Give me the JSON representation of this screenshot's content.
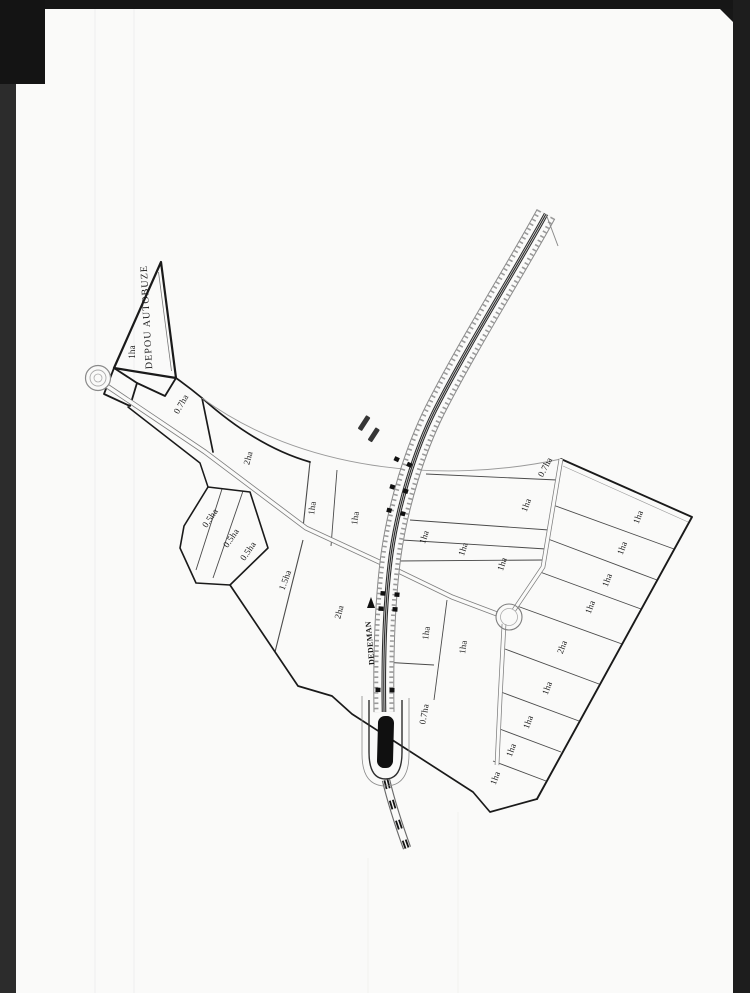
{
  "scan": {
    "frame": {
      "top_color": "#161616",
      "left_bar_color": "#2c2c2c",
      "left_corner_block_color": "#141414",
      "right_bar_color": "#1d1d1d"
    },
    "page_color": "#fafaf9",
    "ink_color": "#1b1b1b"
  },
  "plan": {
    "depot_label": "DEPOU AUTOBUZE",
    "direction_label": "DEDEMAN",
    "labels": [
      {
        "name": "depot-title",
        "text": "DEPOU AUTOBUZE",
        "x": 147,
        "y": 317,
        "angle": -93,
        "size": 10,
        "weight": 400,
        "tracking": 1.1
      },
      {
        "name": "direction",
        "text": "DEDEMAN",
        "x": 370,
        "y": 643,
        "angle": -95,
        "size": 8,
        "weight": 700,
        "tracking": 0.4
      },
      {
        "name": "parcel",
        "text": "1ha",
        "x": 132,
        "y": 352,
        "angle": -90,
        "size": 9
      },
      {
        "name": "parcel",
        "text": "0.7ha",
        "x": 181,
        "y": 404,
        "angle": -60,
        "size": 9
      },
      {
        "name": "parcel",
        "text": "2ha",
        "x": 248,
        "y": 458,
        "angle": -75,
        "size": 9
      },
      {
        "name": "parcel",
        "text": "0.5ha",
        "x": 210,
        "y": 518,
        "angle": -56,
        "size": 9
      },
      {
        "name": "parcel",
        "text": "0.5ha",
        "x": 231,
        "y": 538,
        "angle": -56,
        "size": 9
      },
      {
        "name": "parcel",
        "text": "0.5ha",
        "x": 248,
        "y": 551,
        "angle": -56,
        "size": 9
      },
      {
        "name": "parcel",
        "text": "1.5ha",
        "x": 285,
        "y": 580,
        "angle": -70,
        "size": 9
      },
      {
        "name": "parcel",
        "text": "2ha",
        "x": 339,
        "y": 612,
        "angle": -75,
        "size": 9
      },
      {
        "name": "parcel",
        "text": "1ha",
        "x": 312,
        "y": 508,
        "angle": -82,
        "size": 9
      },
      {
        "name": "parcel",
        "text": "1ha",
        "x": 355,
        "y": 518,
        "angle": -82,
        "size": 9
      },
      {
        "name": "parcel",
        "text": "0.7ha",
        "x": 545,
        "y": 467,
        "angle": -62,
        "size": 9
      },
      {
        "name": "parcel",
        "text": "1ha",
        "x": 526,
        "y": 505,
        "angle": -70,
        "size": 9
      },
      {
        "name": "parcel",
        "text": "1ha",
        "x": 424,
        "y": 537,
        "angle": -72,
        "size": 9
      },
      {
        "name": "parcel",
        "text": "1ha",
        "x": 463,
        "y": 549,
        "angle": -72,
        "size": 9
      },
      {
        "name": "parcel",
        "text": "1ha",
        "x": 502,
        "y": 564,
        "angle": -72,
        "size": 9
      },
      {
        "name": "parcel",
        "text": "1ha",
        "x": 426,
        "y": 633,
        "angle": -82,
        "size": 9
      },
      {
        "name": "parcel",
        "text": "1ha",
        "x": 463,
        "y": 647,
        "angle": -82,
        "size": 9
      },
      {
        "name": "parcel",
        "text": "0.7ha",
        "x": 424,
        "y": 714,
        "angle": -80,
        "size": 9
      },
      {
        "name": "parcel",
        "text": "1ha",
        "x": 638,
        "y": 517,
        "angle": -70,
        "size": 9
      },
      {
        "name": "parcel",
        "text": "1ha",
        "x": 622,
        "y": 548,
        "angle": -70,
        "size": 9
      },
      {
        "name": "parcel",
        "text": "1ha",
        "x": 607,
        "y": 580,
        "angle": -70,
        "size": 9
      },
      {
        "name": "parcel",
        "text": "1ha",
        "x": 590,
        "y": 607,
        "angle": -70,
        "size": 9
      },
      {
        "name": "parcel",
        "text": "2ha",
        "x": 562,
        "y": 647,
        "angle": -70,
        "size": 9
      },
      {
        "name": "parcel",
        "text": "1ha",
        "x": 547,
        "y": 688,
        "angle": -70,
        "size": 9
      },
      {
        "name": "parcel",
        "text": "1ha",
        "x": 528,
        "y": 722,
        "angle": -70,
        "size": 9
      },
      {
        "name": "parcel",
        "text": "1ha",
        "x": 511,
        "y": 750,
        "angle": -70,
        "size": 9
      },
      {
        "name": "parcel",
        "text": "1ha",
        "x": 495,
        "y": 778,
        "angle": -70,
        "size": 9
      }
    ]
  }
}
